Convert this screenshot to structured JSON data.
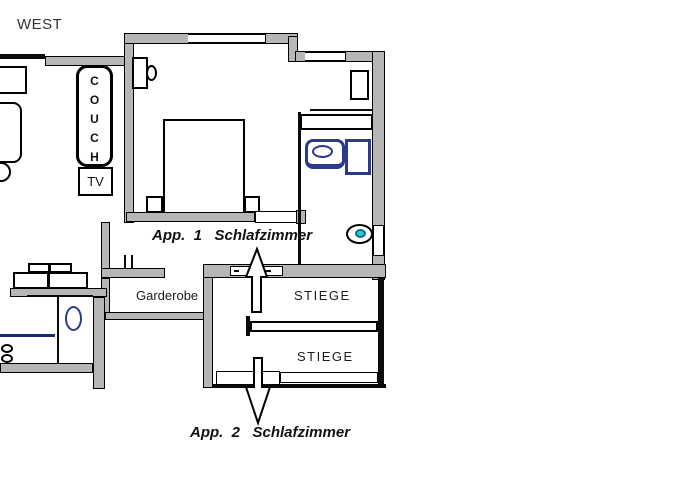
{
  "compass": {
    "west_label": "WEST"
  },
  "plan": {
    "apartment1_label": "App.  1   Schlafzimmer",
    "apartment2_label": "App.  2   Schlafzimmer",
    "garderobe_label": "Garderobe",
    "stiege_upper_label": "STIEGE",
    "stiege_lower_label": "STIEGE",
    "couch_label": "C\nO\nU\nC\nH",
    "tv_label": "TV"
  },
  "colors": {
    "wall_fill": "#b6b6b6",
    "wall_outline": "#000000",
    "bath_fixture_blue": "#2b3a8c",
    "toilet_seat_teal": "#36c3d6",
    "background": "#ffffff",
    "text": "#1a1a1a"
  }
}
